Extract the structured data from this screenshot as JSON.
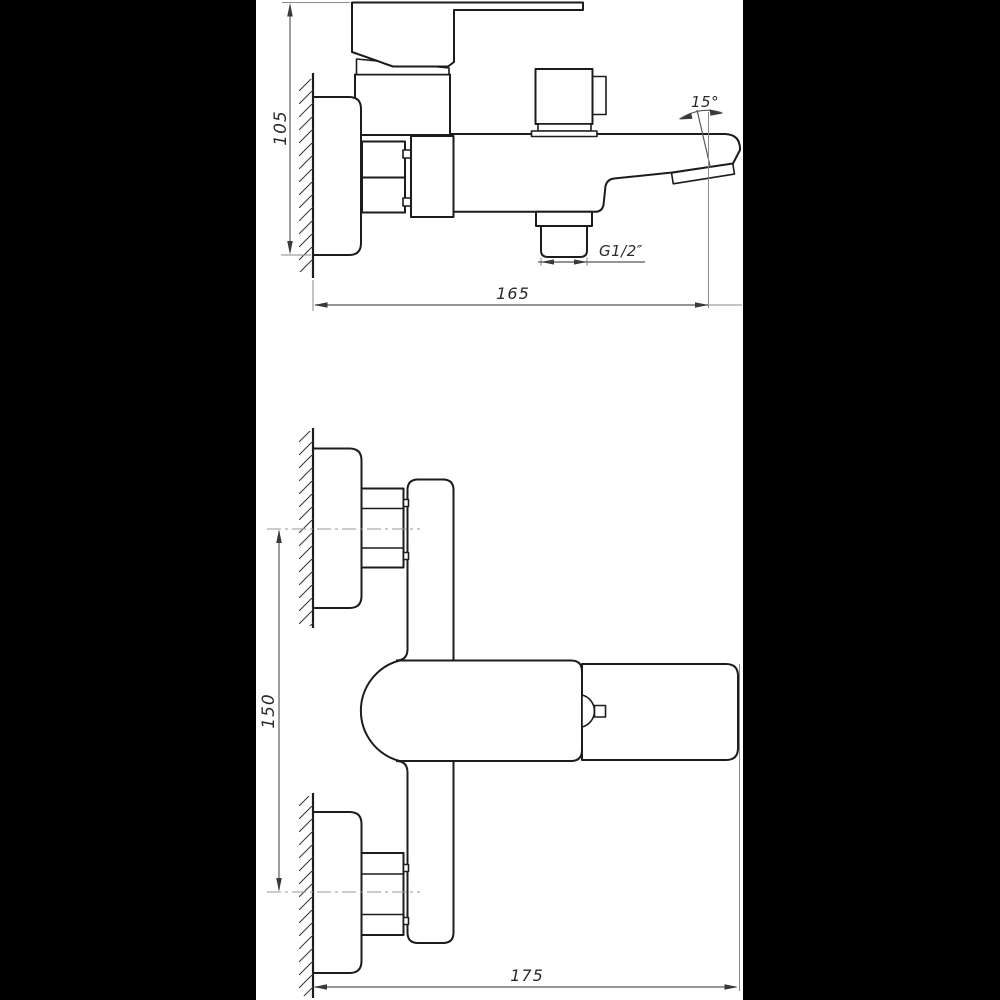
{
  "colors": {
    "matte": "#000000",
    "paper": "#ffffff",
    "line": "#1c1c1c",
    "dimension_line": "#555555"
  },
  "dimensions": {
    "side_view": {
      "mount_height": "105",
      "spout_angle": "15°",
      "thread": "G1/2″",
      "spout_reach": "165"
    },
    "front_view": {
      "connection_centers": "150",
      "overall_width": "175"
    }
  }
}
